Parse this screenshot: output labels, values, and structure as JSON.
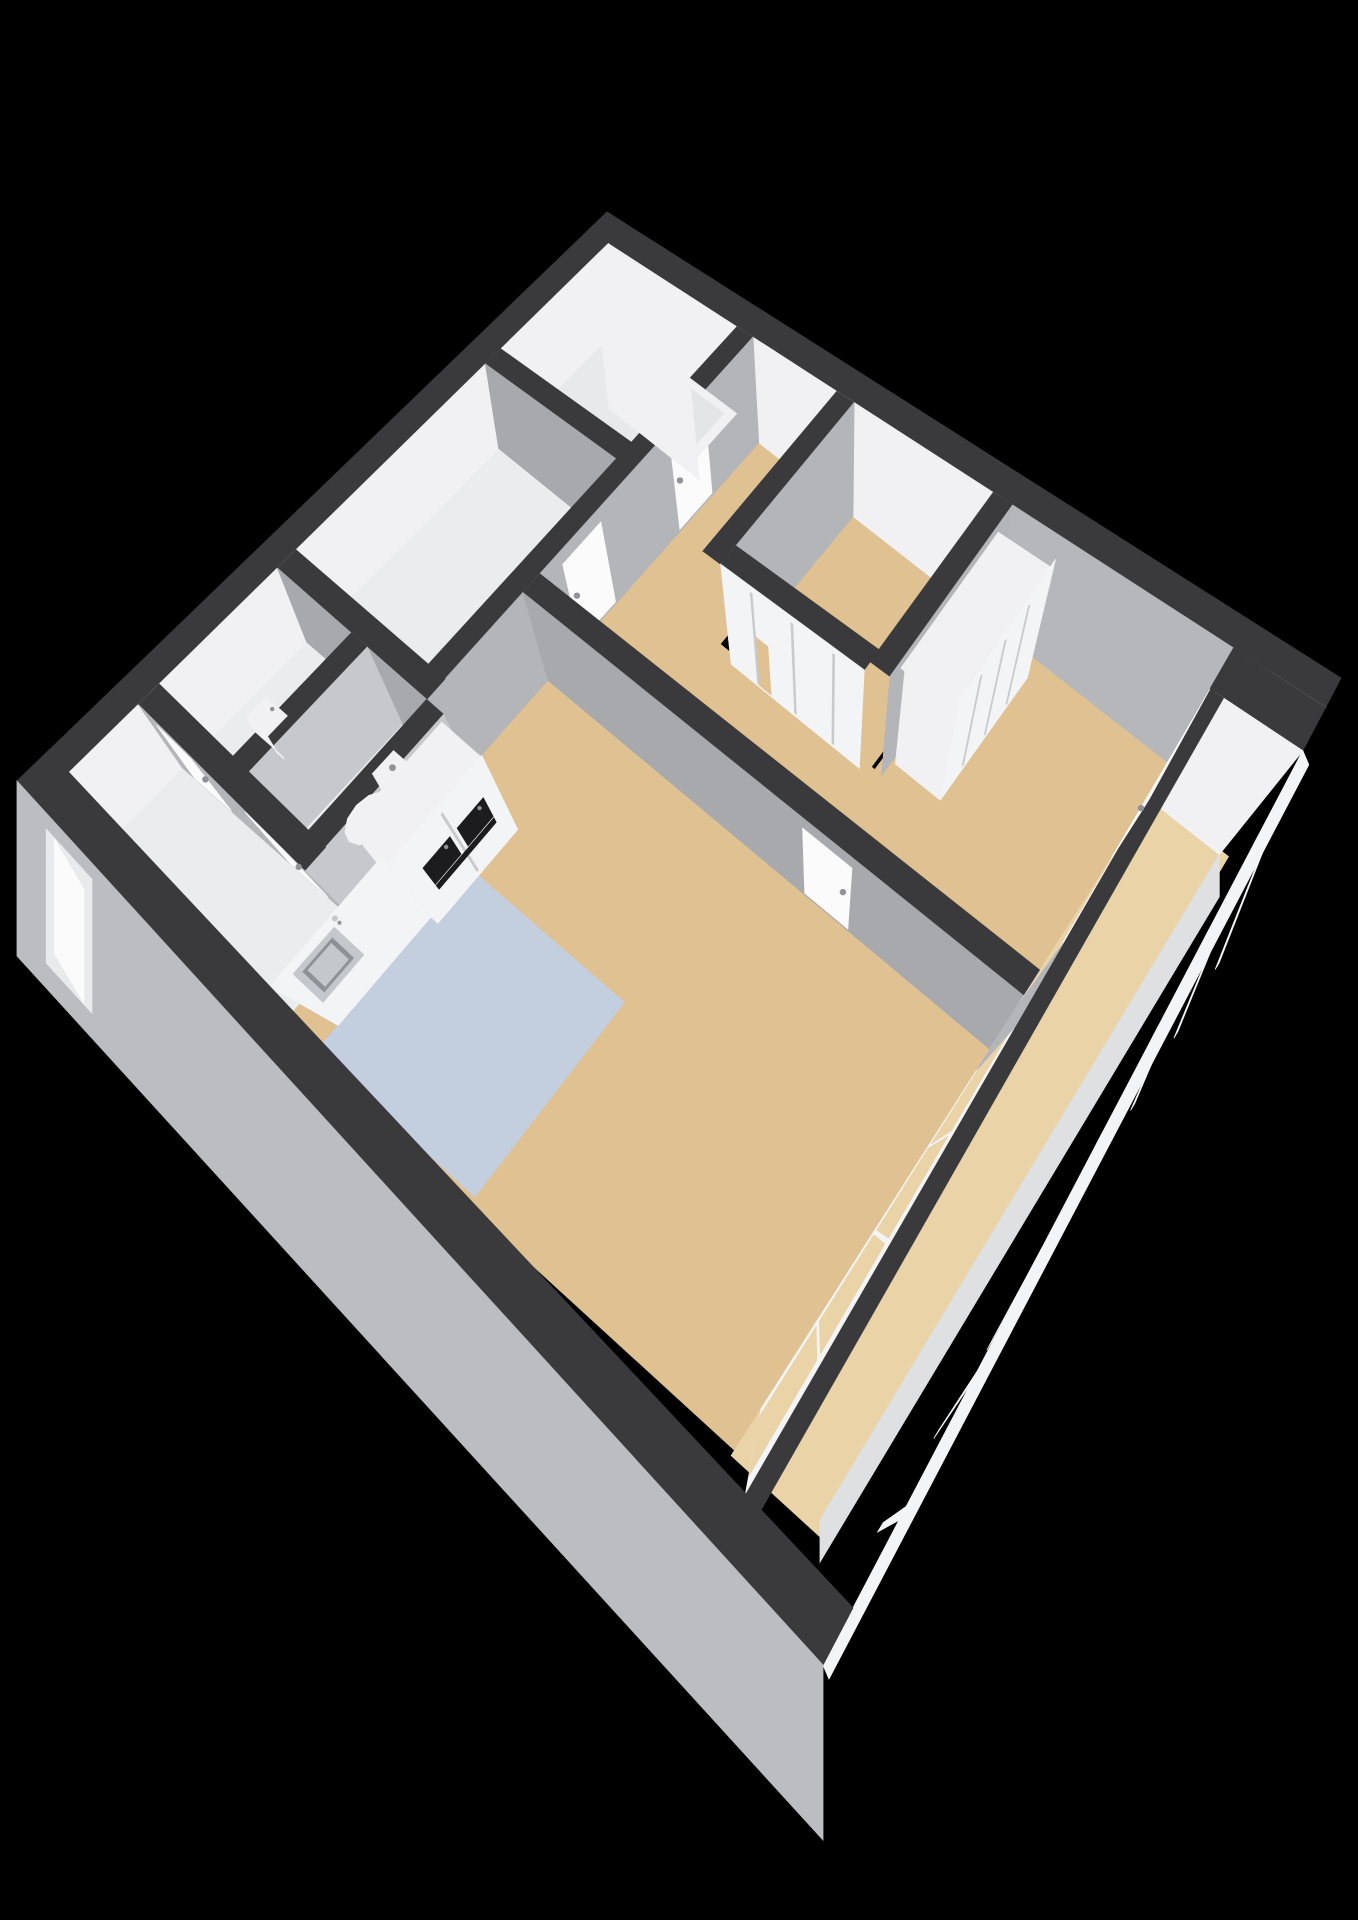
{
  "scene": {
    "type": "3d-floorplan-render",
    "style": "isometric cutaway apartment viewed from above",
    "background": "#000000"
  },
  "palette": {
    "background": "#000000",
    "wall_top": "#3a3a3c",
    "white_face": "#f1f1f3",
    "gray_face_dark": "#a7a9ac",
    "gray_face": "#b4b5b9",
    "gray_face_light": "#c7c8cb",
    "bedroom_wall_gray": "#b5b7ba",
    "ext_outer": "#bcbdc0",
    "floor_beige": "#dfc192",
    "floor_balcony": "#e9d3a7",
    "floor_blue": "#c3cedf",
    "floor_light": "#ebecee",
    "floor_bath": "#e8e9eb",
    "frame_white": "#f3f4f6",
    "counter_black": "#161617",
    "appliance_black": "#1c1c1e",
    "steel": "#c4c8cd",
    "steel_dark": "#8e9297",
    "door_white": "#fbfbfc",
    "seam": "#c9cacc",
    "handle": "#909297",
    "slab": "#dfe0e2",
    "tub_inner": "#e4e5e7"
  },
  "rooms": [
    {
      "id": "bathroom",
      "name": "bathroom",
      "floor_color": "floor_bath"
    },
    {
      "id": "bedroom-top-left",
      "name": "bedroom / study",
      "floor_color": "floor_light"
    },
    {
      "id": "hallway",
      "name": "hallway",
      "floor_color": "floor_beige"
    },
    {
      "id": "corridor",
      "name": "corridor",
      "floor_color": "floor_beige"
    },
    {
      "id": "storage-closet-room",
      "name": "closet storage room",
      "floor_color": "floor_beige"
    },
    {
      "id": "master-bedroom",
      "name": "master bedroom",
      "floor_color": "floor_beige"
    },
    {
      "id": "living-room",
      "name": "living room",
      "floor_color": "floor_beige"
    },
    {
      "id": "kitchen",
      "name": "kitchen zone",
      "floor_color": "floor_blue"
    },
    {
      "id": "entry-hall",
      "name": "entry hall",
      "floor_color": "floor_light"
    },
    {
      "id": "wc-left",
      "name": "cloakroom",
      "floor_color": "floor_light"
    },
    {
      "id": "wc-right",
      "name": "toilet room",
      "floor_color": "floor_light"
    },
    {
      "id": "balcony",
      "name": "balcony / loggia",
      "floor_color": "floor_balcony"
    }
  ],
  "fixtures": [
    {
      "id": "bathtub",
      "label": "bathtub"
    },
    {
      "id": "toilet",
      "label": "toilet"
    },
    {
      "id": "hand-basin",
      "label": "hand basin"
    },
    {
      "id": "kitchen-counter",
      "label": "kitchen counter with black worktop"
    },
    {
      "id": "kitchen-sink",
      "label": "stainless steel sink"
    },
    {
      "id": "tall-cabinets",
      "label": "tall kitchen cabinets"
    },
    {
      "id": "built-in-ovens",
      "label": "two built-in black ovens"
    },
    {
      "id": "closet-sliding-doors",
      "label": "sliding door closets"
    },
    {
      "id": "wardrobe-closet",
      "label": "bedroom wardrobe"
    }
  ],
  "openings": [
    {
      "id": "bathroom-door",
      "label": "bathroom door"
    },
    {
      "id": "bedroom-door",
      "label": "bedroom door"
    },
    {
      "id": "wc-door-left",
      "label": "cloakroom door"
    },
    {
      "id": "wc-door-right",
      "label": "toilet door"
    },
    {
      "id": "living-room-door",
      "label": "living room door"
    },
    {
      "id": "balcony-door",
      "label": "balcony door"
    },
    {
      "id": "entrance-door",
      "label": "entrance door"
    },
    {
      "id": "window-wall",
      "label": "window wall to balcony"
    },
    {
      "id": "balcony-glazing",
      "label": "balcony glass facade"
    }
  ]
}
